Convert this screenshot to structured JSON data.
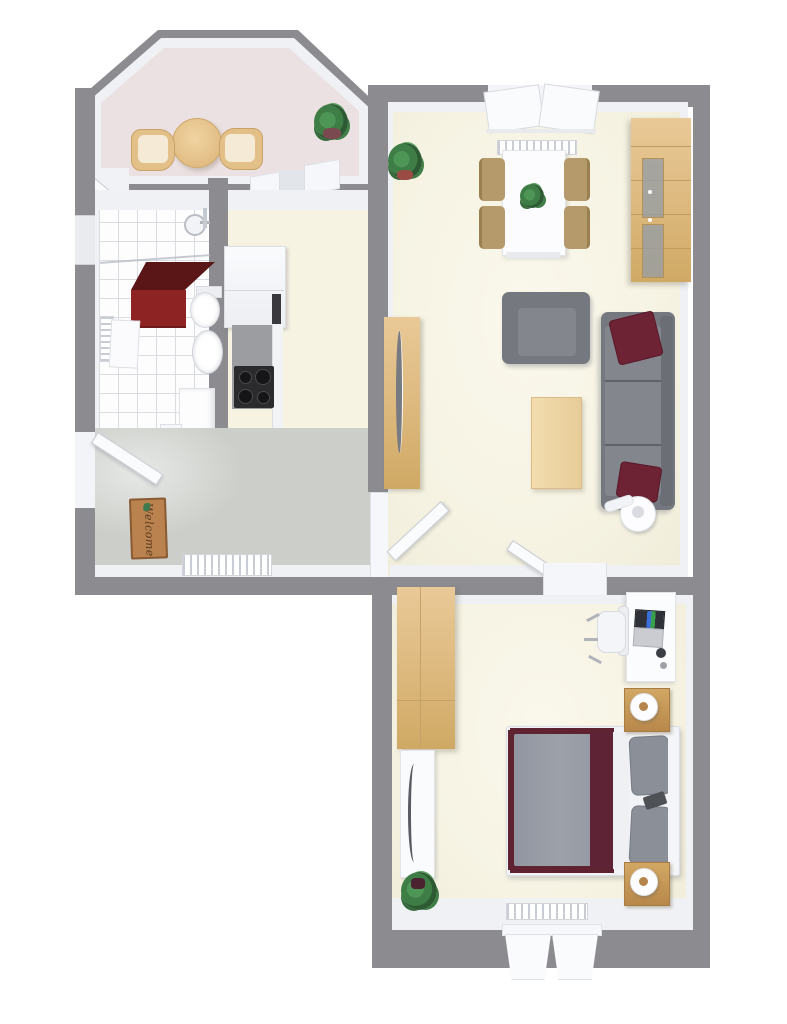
{
  "scene": {
    "kind": "3d-floor-plan-top-down-render",
    "background": "#ffffff",
    "wall_color": "#8c8c90"
  },
  "welcome_mat": {
    "text": "Welcome",
    "color": "#b9824f"
  },
  "colors": {
    "wall": "#8c8c90",
    "inner_wall_face": "#eff1f4",
    "floor_cream": "#f6f3e3",
    "floor_nook_pink": "#ece1e2",
    "floor_hall_gray": "#cbcec9",
    "bathroom_tile": "#fdfdfe",
    "wood_light_oak": "#dcb87d",
    "wood_nightstand": "#c89a58",
    "sofa_gray": "#75787e",
    "bed_duvet_gray": "#999da6",
    "accent_maroon": "#6d2334",
    "bath_cabinet_red": "#8e2323",
    "stove_black": "#2b2b2e"
  },
  "rooms": [
    {
      "id": "dining-nook",
      "floor": "pink",
      "items": [
        "round-table",
        "tub-chair-left",
        "tub-chair-right",
        "potted-plant"
      ]
    },
    {
      "id": "bathroom",
      "floor": "white-tile",
      "items": [
        "shower-head",
        "glass-screen",
        "red-cabinet",
        "toilet",
        "pedestal-sink",
        "towel-radiator",
        "wall-cabinet",
        "washing-machine",
        "open-door"
      ]
    },
    {
      "id": "kitchen",
      "floor": "cream",
      "items": [
        "tall-unit-fridge",
        "built-in-oven",
        "countertop",
        "cooktop"
      ]
    },
    {
      "id": "hallway",
      "floor": "gray",
      "items": [
        "welcome-mat",
        "radiator",
        "entry-door"
      ]
    },
    {
      "id": "living-room",
      "floor": "cream",
      "items": [
        "double-window",
        "radiator",
        "dining-table",
        "dining-chairs-4",
        "table-plant",
        "corner-plant",
        "display-cabinet",
        "armchair",
        "sofa",
        "maroon-cushions-2",
        "coffee-table",
        "wardrobe",
        "floor-lamp",
        "door-to-hall",
        "door-to-bedroom"
      ]
    },
    {
      "id": "bedroom",
      "floor": "cream",
      "items": [
        "wardrobe",
        "mirror-panel",
        "potted-plant",
        "double-bed",
        "pillows-2",
        "nightstands-2",
        "round-lamps-2",
        "desk",
        "laptop",
        "office-chair",
        "radiator",
        "double-window"
      ]
    }
  ]
}
